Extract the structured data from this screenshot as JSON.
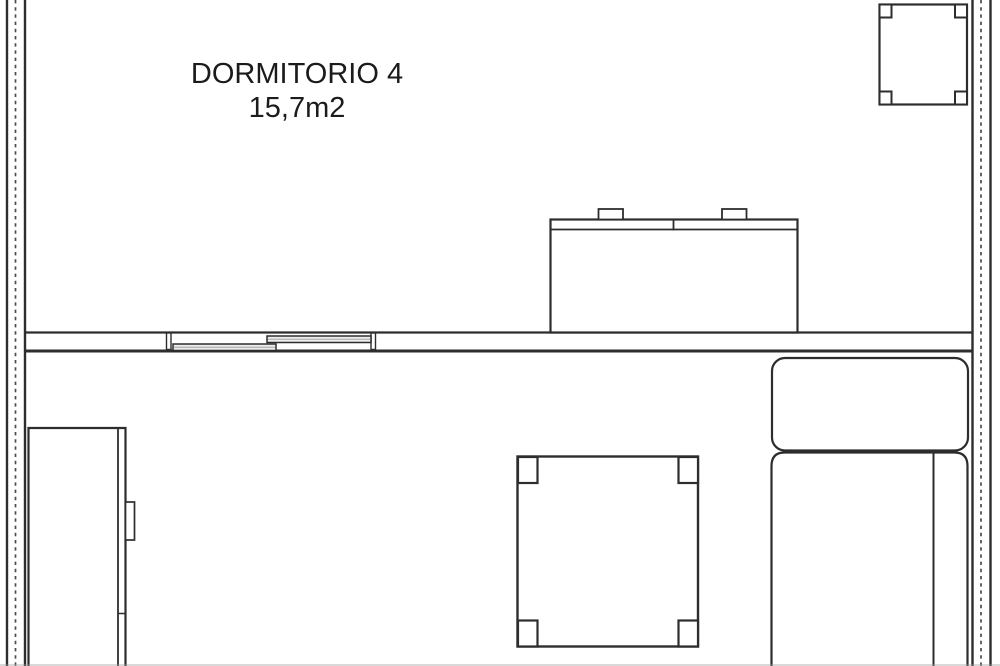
{
  "room": {
    "name": "DORMITORIO 4",
    "area": "15,7m2"
  },
  "colors": {
    "line": "#2d2d2d",
    "wall_dash": "#4b4b4b",
    "background": "#ffffff",
    "text": "#1b1b1b",
    "door_panel": "#ededed"
  },
  "elements": {
    "left_wall": "exterior-wall-with-insulation-hatch",
    "right_wall": "exterior-wall-with-insulation-hatch",
    "divider_wall": "interior-partition-wall",
    "sliding_door": "double-sliding-door",
    "dresser": "dresser-with-two-handles",
    "side_table": "small-square-table-four-legs",
    "wardrobe": "wardrobe-with-handle",
    "coffee_table": "square-table-four-legs",
    "sofa": "sofa-with-chaise-and-armrest"
  }
}
